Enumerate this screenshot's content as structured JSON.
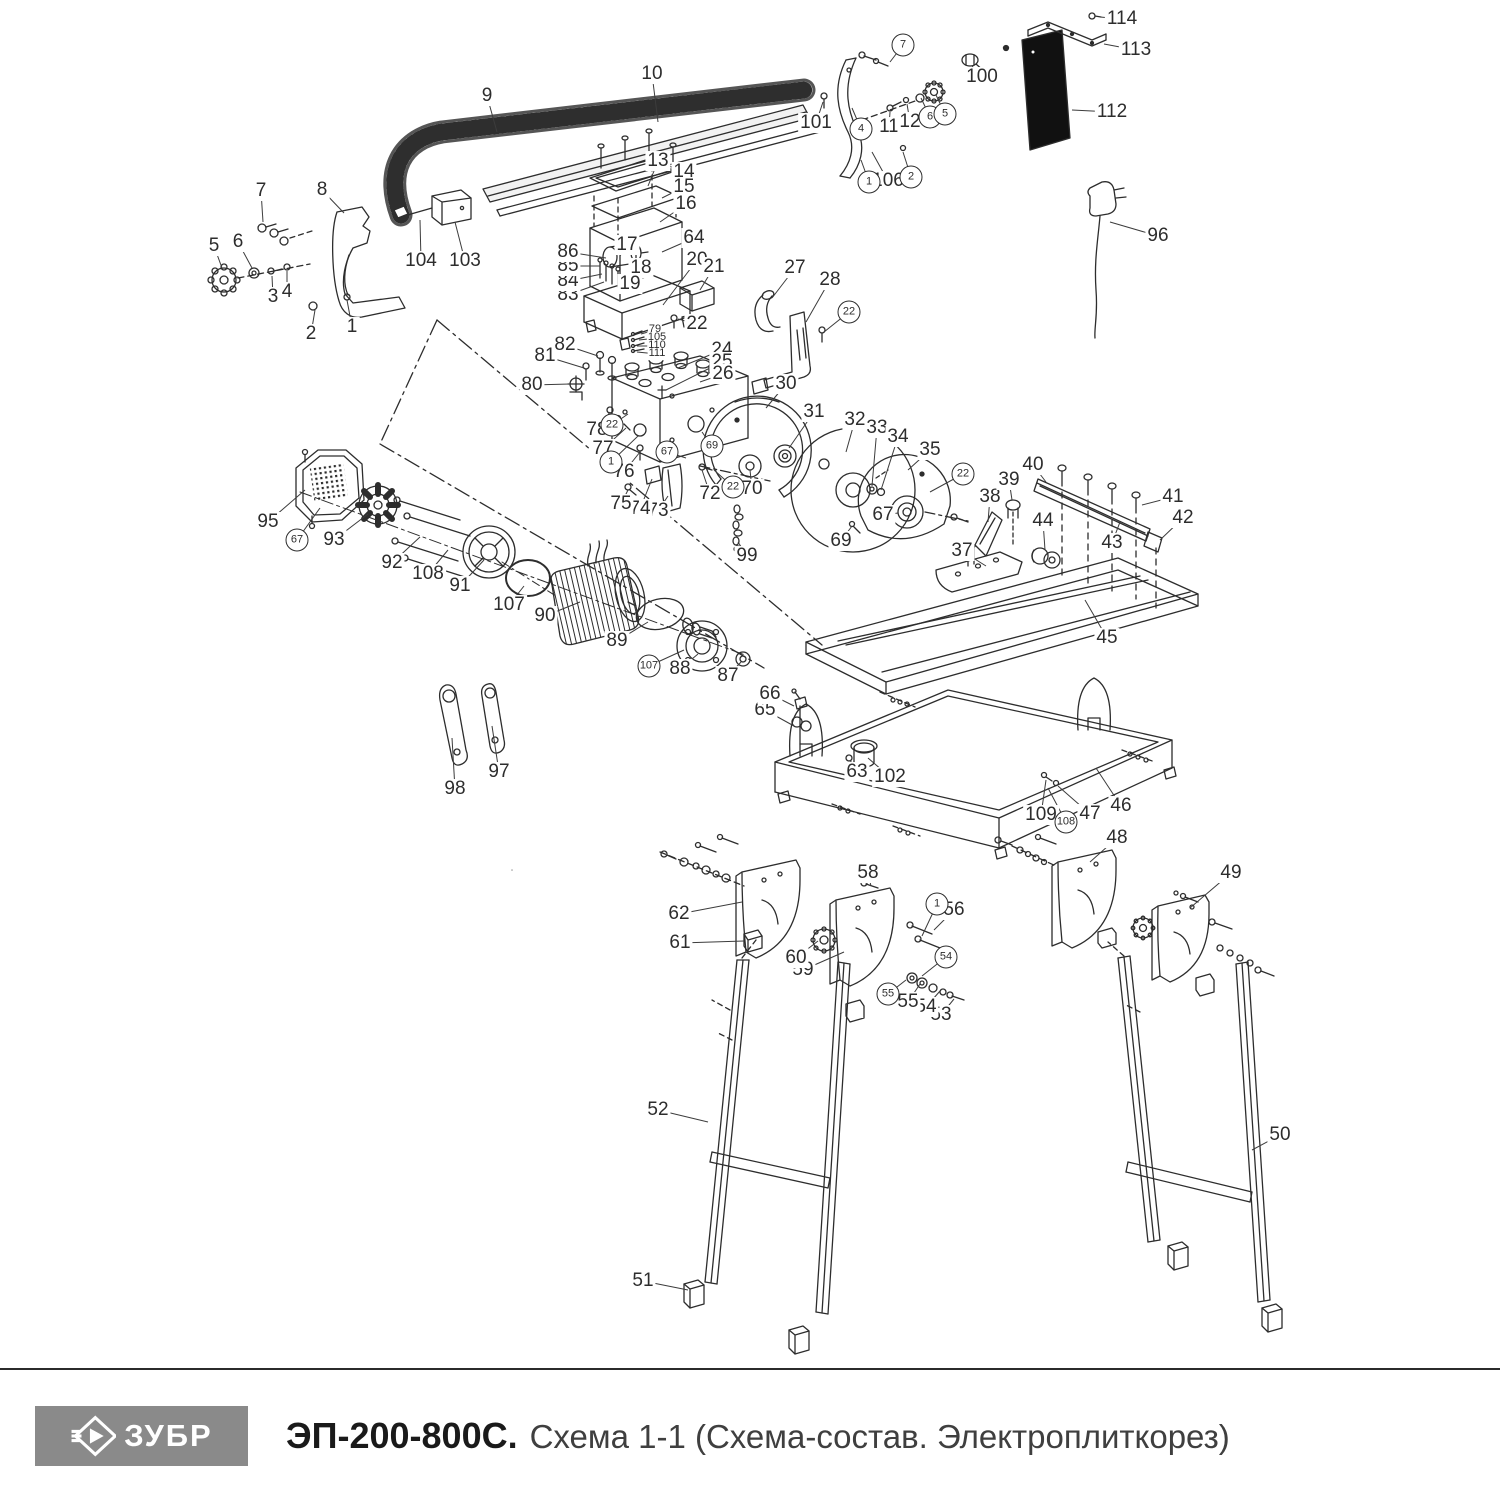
{
  "footer": {
    "brand": "ЗУБР",
    "model": "ЭП-200-800С.",
    "subtitle": "Схема 1-1 (Схема-состав. Электроплиткорез)"
  },
  "colors": {
    "line": "#2d2d2d",
    "panel_black": "#111111",
    "logo_bg": "#8a8a8a",
    "logo_text": "#ffffff",
    "title_text": "#1a1a1a",
    "subtitle_text": "#3f3f3f"
  },
  "labels": [
    {
      "n": "1",
      "x": 352,
      "y": 327,
      "lx": 347,
      "ly": 300
    },
    {
      "n": "2",
      "x": 311,
      "y": 334,
      "lx": 315,
      "ly": 310
    },
    {
      "n": "3",
      "x": 273,
      "y": 297,
      "lx": 272,
      "ly": 276
    },
    {
      "n": "4",
      "x": 287,
      "y": 292,
      "lx": 287,
      "ly": 271
    },
    {
      "n": "5",
      "x": 214,
      "y": 246,
      "lx": 222,
      "ly": 268
    },
    {
      "n": "6",
      "x": 238,
      "y": 242,
      "lx": 252,
      "ly": 268
    },
    {
      "n": "7",
      "x": 261,
      "y": 191,
      "lx": 263,
      "ly": 222
    },
    {
      "n": "8",
      "x": 322,
      "y": 190,
      "lx": 344,
      "ly": 213
    },
    {
      "n": "9",
      "x": 487,
      "y": 96,
      "lx": 497,
      "ly": 132
    },
    {
      "n": "10",
      "x": 652,
      "y": 74,
      "lx": 658,
      "ly": 122
    },
    {
      "n": "11",
      "x": 889,
      "y": 127,
      "lx": 890,
      "ly": 112
    },
    {
      "n": "12",
      "x": 910,
      "y": 122,
      "lx": 907,
      "ly": 104
    },
    {
      "n": "13",
      "x": 658,
      "y": 161,
      "lx": 648,
      "ly": 186
    },
    {
      "n": "14",
      "x": 684,
      "y": 172,
      "lx": 660,
      "ly": 166
    },
    {
      "n": "15",
      "x": 684,
      "y": 187,
      "lx": 662,
      "ly": 198
    },
    {
      "n": "16",
      "x": 686,
      "y": 204,
      "lx": 660,
      "ly": 222
    },
    {
      "n": "17",
      "x": 627,
      "y": 245,
      "lx": 620,
      "ly": 256
    },
    {
      "n": "18",
      "x": 641,
      "y": 268,
      "lx": 633,
      "ly": 268
    },
    {
      "n": "19",
      "x": 630,
      "y": 284,
      "lx": 626,
      "ly": 276
    },
    {
      "n": "20",
      "x": 697,
      "y": 260,
      "lx": 663,
      "ly": 305
    },
    {
      "n": "21",
      "x": 714,
      "y": 267,
      "lx": 700,
      "ly": 290
    },
    {
      "n": "22",
      "x": 697,
      "y": 324,
      "lx": 678,
      "ly": 319
    },
    {
      "n": "24",
      "x": 722,
      "y": 350,
      "lx": 678,
      "ly": 368
    },
    {
      "n": "25",
      "x": 722,
      "y": 362,
      "lx": 666,
      "ly": 390
    },
    {
      "n": "26",
      "x": 723,
      "y": 374,
      "lx": 700,
      "ly": 382
    },
    {
      "n": "27",
      "x": 795,
      "y": 268,
      "lx": 772,
      "ly": 298
    },
    {
      "n": "28",
      "x": 830,
      "y": 280,
      "lx": 806,
      "ly": 322
    },
    {
      "n": "30",
      "x": 786,
      "y": 384,
      "lx": 766,
      "ly": 408
    },
    {
      "n": "31",
      "x": 814,
      "y": 412,
      "lx": 789,
      "ly": 448
    },
    {
      "n": "32",
      "x": 855,
      "y": 420,
      "lx": 846,
      "ly": 452
    },
    {
      "n": "33",
      "x": 877,
      "y": 428,
      "lx": 872,
      "ly": 486
    },
    {
      "n": "34",
      "x": 898,
      "y": 437,
      "lx": 881,
      "ly": 490
    },
    {
      "n": "35",
      "x": 930,
      "y": 450,
      "lx": 908,
      "ly": 470
    },
    {
      "n": "37",
      "x": 962,
      "y": 551,
      "lx": 986,
      "ly": 566
    },
    {
      "n": "38",
      "x": 990,
      "y": 497,
      "lx": 988,
      "ly": 522
    },
    {
      "n": "39",
      "x": 1009,
      "y": 480,
      "lx": 1012,
      "ly": 500
    },
    {
      "n": "40",
      "x": 1033,
      "y": 465,
      "lx": 1046,
      "ly": 482
    },
    {
      "n": "41",
      "x": 1173,
      "y": 497,
      "lx": 1142,
      "ly": 505
    },
    {
      "n": "42",
      "x": 1183,
      "y": 518,
      "lx": 1160,
      "ly": 540
    },
    {
      "n": "43",
      "x": 1112,
      "y": 543,
      "lx": 1120,
      "ly": 522
    },
    {
      "n": "44",
      "x": 1043,
      "y": 521,
      "lx": 1045,
      "ly": 550
    },
    {
      "n": "45",
      "x": 1107,
      "y": 638,
      "lx": 1085,
      "ly": 600
    },
    {
      "n": "46",
      "x": 1121,
      "y": 806,
      "lx": 1096,
      "ly": 768
    },
    {
      "n": "47",
      "x": 1090,
      "y": 814,
      "lx": 1058,
      "ly": 786
    },
    {
      "n": "48",
      "x": 1117,
      "y": 838,
      "lx": 1090,
      "ly": 862
    },
    {
      "n": "49",
      "x": 1231,
      "y": 873,
      "lx": 1190,
      "ly": 908
    },
    {
      "n": "50",
      "x": 1280,
      "y": 1135,
      "lx": 1252,
      "ly": 1150
    },
    {
      "n": "51",
      "x": 643,
      "y": 1281,
      "lx": 688,
      "ly": 1290
    },
    {
      "n": "52",
      "x": 658,
      "y": 1110,
      "lx": 708,
      "ly": 1122
    },
    {
      "n": "53",
      "x": 941,
      "y": 1015,
      "lx": 954,
      "ly": 999
    },
    {
      "n": "54",
      "x": 926,
      "y": 1007,
      "lx": 940,
      "ly": 991
    },
    {
      "n": "55",
      "x": 908,
      "y": 1002,
      "lx": 920,
      "ly": 984
    },
    {
      "n": "56",
      "x": 954,
      "y": 910,
      "lx": 934,
      "ly": 930
    },
    {
      "n": "58",
      "x": 868,
      "y": 873,
      "lx": 871,
      "ly": 886
    },
    {
      "n": "59",
      "x": 803,
      "y": 970,
      "lx": 844,
      "ly": 952
    },
    {
      "n": "60",
      "x": 796,
      "y": 958,
      "lx": 818,
      "ly": 941
    },
    {
      "n": "61",
      "x": 680,
      "y": 943,
      "lx": 744,
      "ly": 941
    },
    {
      "n": "62",
      "x": 679,
      "y": 914,
      "lx": 742,
      "ly": 902
    },
    {
      "n": "63",
      "x": 857,
      "y": 772,
      "lx": 850,
      "ly": 760
    },
    {
      "n": "64",
      "x": 694,
      "y": 238,
      "lx": 662,
      "ly": 252
    },
    {
      "n": "65",
      "x": 765,
      "y": 710,
      "lx": 794,
      "ly": 726
    },
    {
      "n": "66",
      "x": 770,
      "y": 694,
      "lx": 794,
      "ly": 706
    },
    {
      "n": "67",
      "x": 883,
      "y": 515,
      "lx": 898,
      "ly": 513
    },
    {
      "n": "69",
      "x": 841,
      "y": 541,
      "lx": 852,
      "ly": 526
    },
    {
      "n": "70",
      "x": 752,
      "y": 489,
      "lx": 750,
      "ly": 470
    },
    {
      "n": "72",
      "x": 710,
      "y": 494,
      "lx": 702,
      "ly": 470
    },
    {
      "n": "73",
      "x": 658,
      "y": 511,
      "lx": 668,
      "ly": 496
    },
    {
      "n": "74",
      "x": 640,
      "y": 509,
      "lx": 652,
      "ly": 479
    },
    {
      "n": "75",
      "x": 621,
      "y": 504,
      "lx": 628,
      "ly": 490
    },
    {
      "n": "76",
      "x": 624,
      "y": 472,
      "lx": 640,
      "ly": 452
    },
    {
      "n": "77",
      "x": 603,
      "y": 449,
      "lx": 626,
      "ly": 428
    },
    {
      "n": "78",
      "x": 597,
      "y": 430,
      "lx": 610,
      "ly": 412
    },
    {
      "n": "80",
      "x": 532,
      "y": 385,
      "lx": 570,
      "ly": 384
    },
    {
      "n": "81",
      "x": 545,
      "y": 356,
      "lx": 584,
      "ly": 368
    },
    {
      "n": "82",
      "x": 565,
      "y": 345,
      "lx": 598,
      "ly": 356
    },
    {
      "n": "83",
      "x": 568,
      "y": 295,
      "lx": 604,
      "ly": 282
    },
    {
      "n": "84",
      "x": 568,
      "y": 281,
      "lx": 602,
      "ly": 274
    },
    {
      "n": "85",
      "x": 568,
      "y": 266,
      "lx": 600,
      "ly": 266
    },
    {
      "n": "86",
      "x": 568,
      "y": 252,
      "lx": 606,
      "ly": 258
    },
    {
      "n": "87",
      "x": 728,
      "y": 676,
      "lx": 741,
      "ly": 662
    },
    {
      "n": "88",
      "x": 680,
      "y": 669,
      "lx": 698,
      "ly": 654
    },
    {
      "n": "89",
      "x": 617,
      "y": 641,
      "lx": 648,
      "ly": 622
    },
    {
      "n": "90",
      "x": 545,
      "y": 616,
      "lx": 580,
      "ly": 602
    },
    {
      "n": "91",
      "x": 460,
      "y": 586,
      "lx": 484,
      "ly": 560
    },
    {
      "n": "92",
      "x": 392,
      "y": 563,
      "lx": 420,
      "ly": 537
    },
    {
      "n": "93",
      "x": 334,
      "y": 540,
      "lx": 368,
      "ly": 514
    },
    {
      "n": "95",
      "x": 268,
      "y": 522,
      "lx": 305,
      "ly": 490
    },
    {
      "n": "96",
      "x": 1158,
      "y": 236,
      "lx": 1110,
      "ly": 222
    },
    {
      "n": "97",
      "x": 499,
      "y": 772,
      "lx": 492,
      "ly": 726
    },
    {
      "n": "98",
      "x": 455,
      "y": 789,
      "lx": 452,
      "ly": 738
    },
    {
      "n": "99",
      "x": 747,
      "y": 556,
      "lx": 738,
      "ly": 542
    },
    {
      "n": "100",
      "x": 982,
      "y": 77,
      "lx": 972,
      "ly": 66
    },
    {
      "n": "101",
      "x": 816,
      "y": 123,
      "lx": 823,
      "ly": 102
    },
    {
      "n": "102",
      "x": 890,
      "y": 777,
      "lx": 868,
      "ly": 758
    },
    {
      "n": "103",
      "x": 465,
      "y": 261,
      "lx": 455,
      "ly": 222
    },
    {
      "n": "104",
      "x": 421,
      "y": 261,
      "lx": 420,
      "ly": 220
    },
    {
      "n": "106",
      "x": 888,
      "y": 181,
      "lx": 872,
      "ly": 152
    },
    {
      "n": "107",
      "x": 509,
      "y": 605,
      "lx": 524,
      "ly": 586
    },
    {
      "n": "108",
      "x": 428,
      "y": 574,
      "lx": 448,
      "ly": 550
    },
    {
      "n": "109",
      "x": 1041,
      "y": 815,
      "lx": 1046,
      "ly": 780
    },
    {
      "n": "112",
      "x": 1112,
      "y": 112,
      "lx": 1072,
      "ly": 110
    },
    {
      "n": "113",
      "x": 1136,
      "y": 50,
      "lx": 1104,
      "ly": 44
    },
    {
      "n": "114",
      "x": 1122,
      "y": 19,
      "lx": 1100,
      "ly": 17
    },
    {
      "n": "79",
      "x": 655,
      "y": 330,
      "lx": 641,
      "ly": 334,
      "s": 1
    },
    {
      "n": "105",
      "x": 657,
      "y": 338,
      "lx": 639,
      "ly": 340,
      "s": 1
    },
    {
      "n": "110",
      "x": 657,
      "y": 346,
      "lx": 637,
      "ly": 346,
      "s": 1
    },
    {
      "n": "111",
      "x": 657,
      "y": 354,
      "lx": 637,
      "ly": 352,
      "s": 1
    },
    {
      "n": "7",
      "x": 903,
      "y": 45,
      "lx": 890,
      "ly": 62,
      "c": 1
    },
    {
      "n": "4",
      "x": 861,
      "y": 129,
      "lx": 852,
      "ly": 108,
      "c": 1
    },
    {
      "n": "6",
      "x": 930,
      "y": 117,
      "lx": 921,
      "ly": 98,
      "c": 1
    },
    {
      "n": "5",
      "x": 945,
      "y": 114,
      "lx": 936,
      "ly": 95,
      "c": 1
    },
    {
      "n": "1",
      "x": 869,
      "y": 182,
      "lx": 861,
      "ly": 160,
      "c": 1
    },
    {
      "n": "2",
      "x": 911,
      "y": 177,
      "lx": 903,
      "ly": 152,
      "c": 1
    },
    {
      "n": "22",
      "x": 849,
      "y": 312,
      "lx": 824,
      "ly": 332,
      "c": 1
    },
    {
      "n": "22",
      "x": 963,
      "y": 474,
      "lx": 930,
      "ly": 492,
      "c": 1
    },
    {
      "n": "22",
      "x": 612,
      "y": 425,
      "lx": 628,
      "ly": 414,
      "c": 1
    },
    {
      "n": "1",
      "x": 611,
      "y": 462,
      "lx": 638,
      "ly": 436,
      "c": 1
    },
    {
      "n": "67",
      "x": 667,
      "y": 452,
      "lx": 686,
      "ly": 458,
      "c": 1
    },
    {
      "n": "69",
      "x": 712,
      "y": 446,
      "lx": 702,
      "ly": 432,
      "c": 1
    },
    {
      "n": "22",
      "x": 733,
      "y": 487,
      "lx": 714,
      "ly": 470,
      "c": 1
    },
    {
      "n": "67",
      "x": 297,
      "y": 540,
      "lx": 320,
      "ly": 508,
      "c": 1
    },
    {
      "n": "107",
      "x": 649,
      "y": 666,
      "lx": 684,
      "ly": 650,
      "c": 1
    },
    {
      "n": "108",
      "x": 1066,
      "y": 822,
      "lx": 1048,
      "ly": 788,
      "c": 1
    },
    {
      "n": "1",
      "x": 937,
      "y": 904,
      "lx": 922,
      "ly": 936,
      "c": 1
    },
    {
      "n": "54",
      "x": 946,
      "y": 957,
      "lx": 922,
      "ly": 976,
      "c": 1
    },
    {
      "n": "55",
      "x": 888,
      "y": 994,
      "lx": 906,
      "ly": 980,
      "c": 1
    }
  ]
}
